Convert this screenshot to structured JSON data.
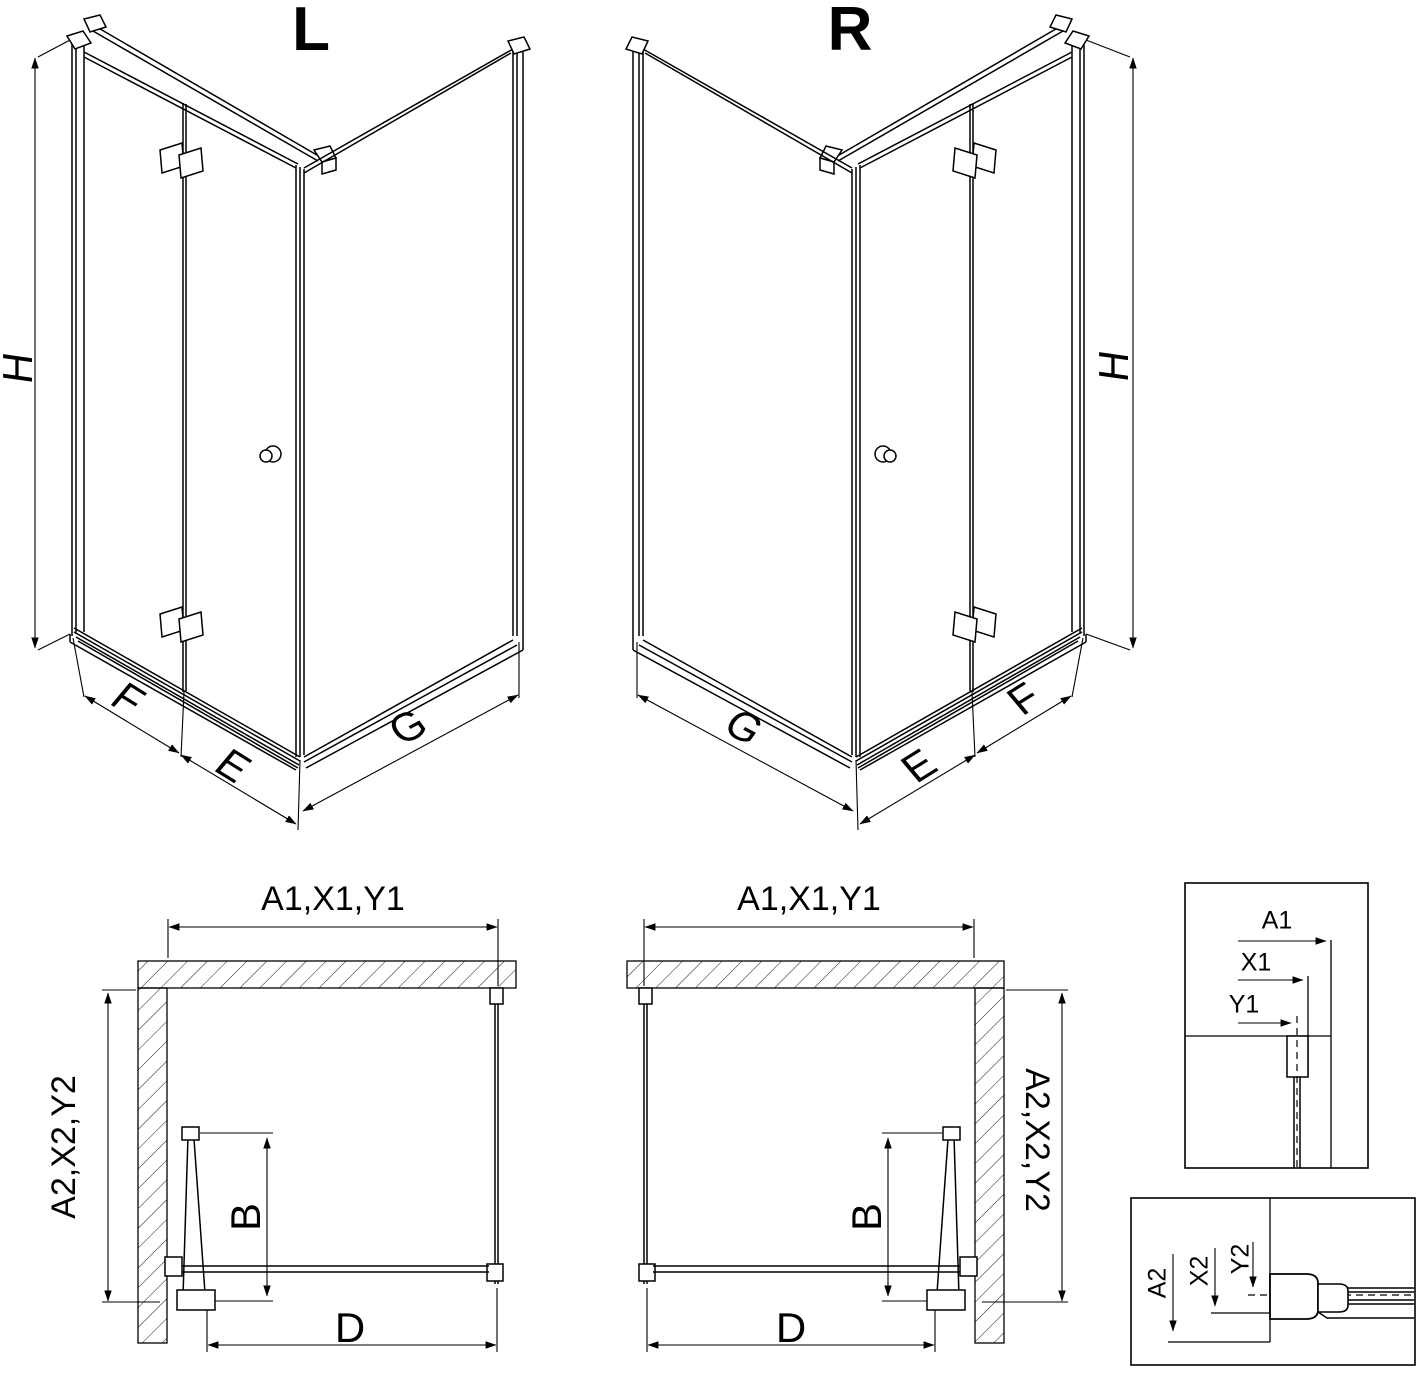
{
  "colors": {
    "line": "#000000",
    "background": "#ffffff"
  },
  "iso_left": {
    "variant": "L",
    "h": "H",
    "f": "F",
    "e": "E",
    "g": "G"
  },
  "iso_right": {
    "variant": "R",
    "h": "H",
    "f": "F",
    "e": "E",
    "g": "G"
  },
  "plan_left": {
    "width": "A1,X1,Y1",
    "depth": "A2,X2,Y2",
    "b": "B",
    "d": "D"
  },
  "plan_right": {
    "width": "A1,X1,Y1",
    "depth": "A2,X2,Y2",
    "b": "B",
    "d": "D"
  },
  "detail_top": {
    "a1": "A1",
    "x1": "X1",
    "y1": "Y1"
  },
  "detail_bottom": {
    "a2": "A2",
    "x2": "X2",
    "y2": "Y2"
  }
}
